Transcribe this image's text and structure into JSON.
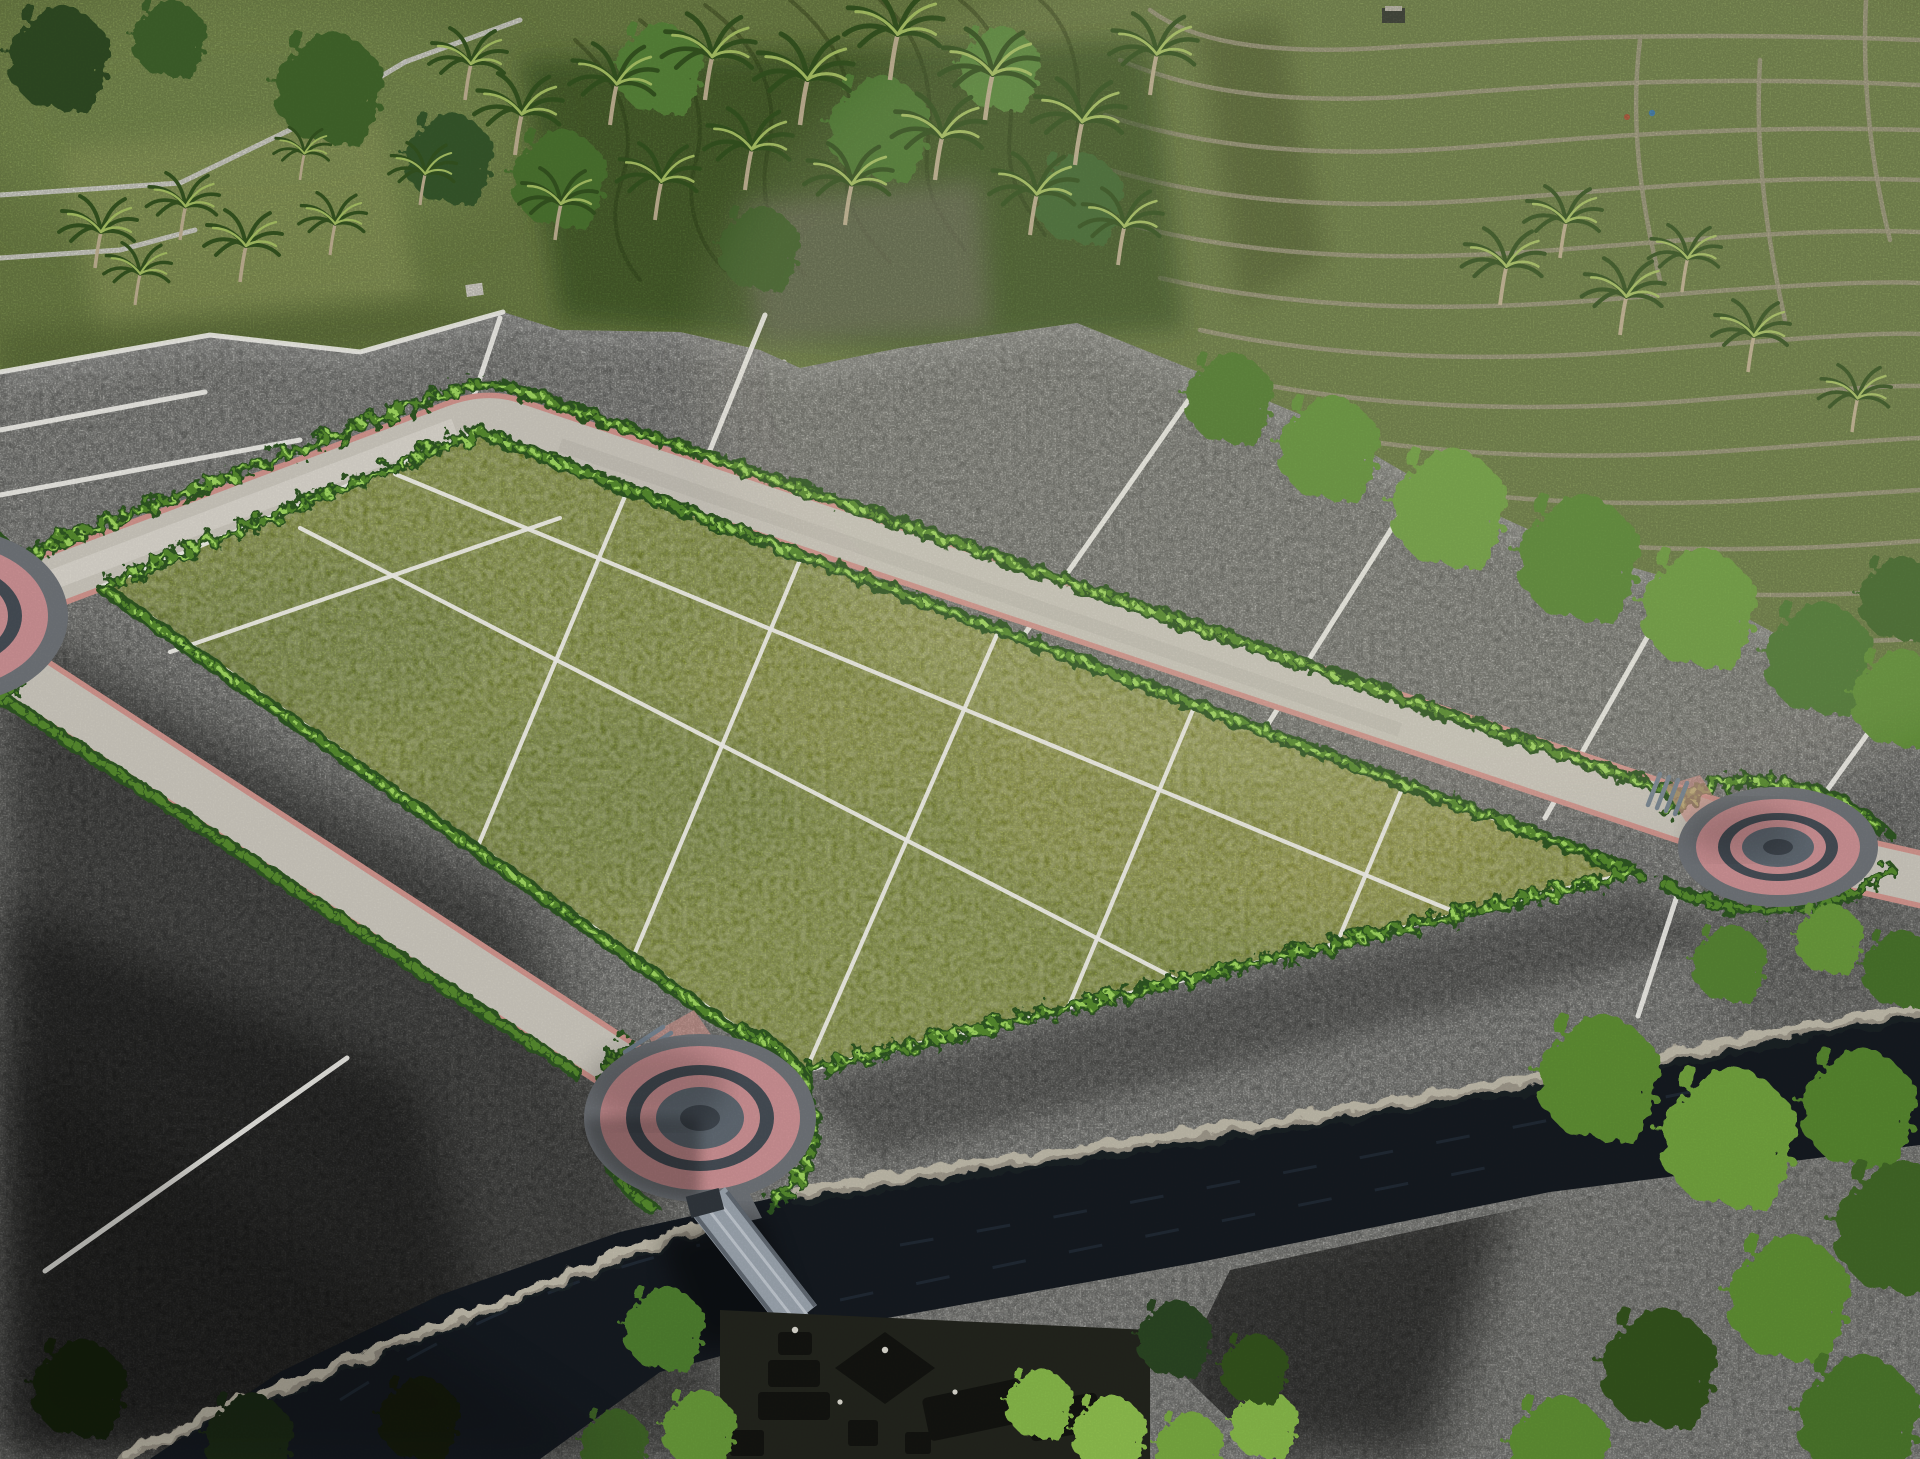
{
  "meta": {
    "title": "Aerial master-plan render of a subdivided land estate",
    "description": "Photorealistic drone-style render: a bright green grid of land plots bordered by a looping concrete road with pink paver edging and three concentric-ring roundabouts. The surrounding survey land is shown desaturated grey and divided by white parcel lines. Behind it lie colour rice paddies, curving rice terraces, a coconut palm grove and tree lines. A dark river with stone retaining walls crosses the foreground, spanned by a stepped footbridge that leads to a Balinese temple compound with dark tiered roofs.",
    "width_px": 1920,
    "height_px": 1459
  },
  "scene": {
    "background": {
      "label": "surrounding landscape in full colour",
      "features": [
        "rice paddies",
        "curved rice-terrace bunds",
        "coconut palm grove",
        "tree line",
        "farm huts",
        "tiny figures in the terraces"
      ]
    },
    "site": {
      "label": "survey area rendered in greyscale",
      "boundary_line_color": "white",
      "visible_outer_parcels": 14
    },
    "green_plots": {
      "label": "subdivided plots for sale highlighted in green",
      "rows": 3,
      "columns": 5,
      "divider_line_color": "white",
      "border": "clipped hedge rows"
    },
    "road": {
      "label": "internal loop road",
      "surface": "light concrete with pink paver edging",
      "roundabout_style": "concentric pink and grey paver rings",
      "roundabouts": [
        {
          "id": "west",
          "position": "left edge, partially visible"
        },
        {
          "id": "south",
          "position": "lower left, beside the footbridge"
        },
        {
          "id": "east",
          "position": "right side, with short exit stub"
        }
      ]
    },
    "water": {
      "label": "river in shadow",
      "walls": "stone retaining walls along both banks"
    },
    "bridge": {
      "label": "stepped footbridge over the river"
    },
    "temple": {
      "label": "Balinese temple compound with dark tiered meru roofs"
    },
    "lighting": {
      "sun_direction": "upper right",
      "shadows": "soft shadows falling to the lower left"
    }
  },
  "palette": {
    "bg-green": "#7d9150",
    "field-light": "#9dac66",
    "field-mid": "#8ba05c",
    "field-dark": "#5d7039",
    "terrace-line": "#b3ac90",
    "terrace-dark": "#53622f",
    "gray-field": "#8f908c",
    "gray-light": "#b9b9b4",
    "gray-dark": "#3c3d38",
    "white-line": "#efeee8",
    "road": "#c9c5bb",
    "road-light": "#d8d4ca",
    "curb-pink": "#cf938c",
    "hedge-dark": "#2e5520",
    "hedge-mid": "#55892e",
    "hedge-light": "#9ed45e",
    "plot-green": "#97a83f",
    "plot-yellow": "#c9c553",
    "plot-dark": "#6e8832",
    "rb-pink": "#c98f92",
    "rb-dark": "#454c54",
    "rb-disc": "#5f6871",
    "rb-core": "#3f464e",
    "rb-apron": "#6e7277",
    "river": "#151a20",
    "river-streak": "#2b3845",
    "wall": "#9b9588",
    "wall-light": "#c6c0b0",
    "wall-dark": "#20242a",
    "bridge": "#9aa3ad",
    "bridge-light": "#c7ced6",
    "bridge-dark": "#5a626b",
    "canopy": "#5d8c33",
    "canopy-dark": "#33511f",
    "canopy-bright": "#85b54a",
    "canopy-black": "#16200f",
    "temple": "#131410",
    "trunk": "#b9ab8d"
  }
}
